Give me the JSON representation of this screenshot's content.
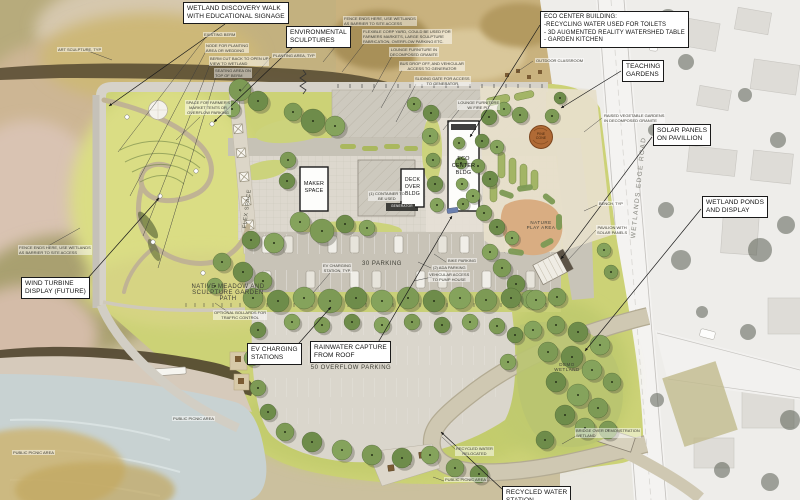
{
  "callouts": {
    "wetland_walk": "WETLAND DISCOVERY WALK\nWITH EDUCATIONAL SIGNAGE",
    "environmental_sculptures": "ENVIRONMENTAL\nSCULPTURES",
    "eco_center_building": "ECO CENTER BUILDING:\n-RECYCLING WATER USED FOR TOILETS\n- 3D AUGMENTED REALITY WATERSHED TABLE\n- GARDEN KITCHEN",
    "teaching_gardens": "TEACHING\nGARDENS",
    "solar_panels": "SOLAR PANELS\nON PAVILLION",
    "wetland_ponds": "WETLAND PONDS\nAND DISPLAY",
    "wind_turbine": "WIND TURBINE\nDISPLAY (FUTURE)",
    "ev_charging": "EV CHARGING\nSTATIONS",
    "rainwater_capture": "RAINWATER CAPTURE\nFROM ROOF",
    "recycled_water": "RECYCLED WATER\nSTATION"
  },
  "buildings": {
    "maker_space": "MAKER\nSPACE",
    "deck_over_bldg": "DECK\nOVER\nBLDG",
    "eco_center_bldg": "ECO\nCENTER\nBLDG"
  },
  "areas": {
    "parking_30": "30 PARKING",
    "overflow_parking": "50 OVERFLOW PARKING",
    "native_meadow": "NATIVE MEADOW AND\nSCULPTURE GARDEN\nPATH",
    "flex_space": "FLEX SPACE",
    "nature_play": "NATURE\nPLAY AREA",
    "demo_wetland": "DEMO\nWETLAND",
    "wetlands_edge_road": "WETLANDS EDGE ROAD",
    "pine_cone": "PINE\nCONE"
  },
  "annotations": {
    "art_sculpture": "ART SCULPTURE, TYP",
    "existing_berm": "EXISTING BERM",
    "node_planting": "NODE FOR PLANTING\nAREA OR WEDDING",
    "berm_cut": "BERM CUT BACK TO OPEN UP\nVIEW TO WETLAND",
    "seating_berm": "SEATING AREA ON\nTOP OF BERM",
    "planting_area": "PLANTING AREA, TYP",
    "space_farmers": "SPACE FOR FARMER'S\nMARKET TENTS OR\nOVERFLOW PARKING",
    "fence_ends_top": "FENCE ENDS HERE, USE WETLANDS\nAS BARRIER TO SITE ACCESS",
    "flexible_corp_yard": "FLEXIBLE CORP YARD, COULD BE USED FOR\nFARMERS MARKETS, LARGE SCULPTURE\nFABRICATION, OVERFLOW PARKING ETC.",
    "lounge_granite": "LOUNGE FURNITURE IN\nDECOMPOSED GRANITE",
    "bus_drop": "BUS DROP OFF, AND VEHICULAR\nACCESS TO GENERATOR",
    "sliding_gate": "SLIDING GATE FOR ACCESS\nTO GENERATOR",
    "lounge_fire": "LOUNGE FURNITURE\nW/ FIRE PIT",
    "outdoor_classroom": "OUTDOOR CLASSROOM",
    "fence_ends_left": "FENCE ENDS HERE, USE WETLANDS\nAS BARRIER TO SITE ACCESS",
    "optional_bollards": "OPTIONAL BOLLARDS FOR\nTRAFFIC CONTROL",
    "ev_station_typ": "EV CHARGING\nSTATION, TYP",
    "bike_parking": "BIKE PARKING",
    "ada_parking": "(2) ADA PARKING",
    "vehicular_access": "VEHICULAR ACCESS\nTO PUMP HOUSE",
    "raised_veg": "RAISED VEGETABLE GARDENS\nIN DECOMPOSED GRANITE",
    "pavilion_solar": "PAVILION WITH\nSOLAR PANELS",
    "bench_typ": "BENCH, TYP",
    "container": "(1) CONTAINER TO\nBE USED",
    "generator": "GENERATOR",
    "recycled_relocated": "RECYCLED WATER\nRELOCATED",
    "public_picnic_1": "PUBLIC PICNIC AREA",
    "public_picnic_2": "PUBLIC PICNIC AREA",
    "public_picnic_3": "PUBLIC PICNIC AREA",
    "bridge_demo": "BRIDGE OVER DEMONSTRATION\nWETLAND"
  },
  "colors": {
    "lawn": "#ccd276",
    "tree": "#7d9a55",
    "path": "#cfc8b2",
    "water": "#c8d2d2",
    "ink": "#1a1a1a",
    "pinecone": "#b06a35",
    "natureplay": "#d9ad82"
  }
}
